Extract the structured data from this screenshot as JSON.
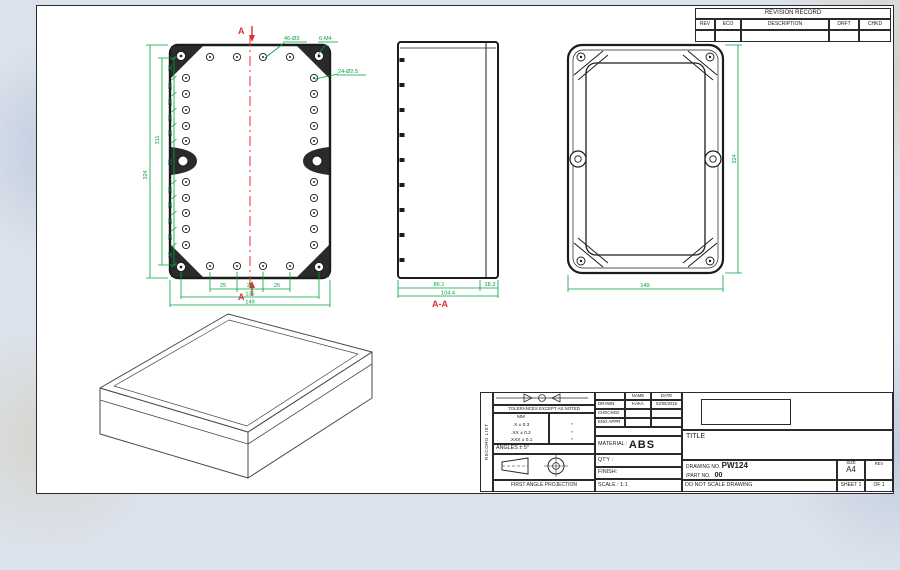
{
  "colors": {
    "dimension_green": "#00a33c",
    "section_red": "#e03231",
    "line_black": "#1c1c1c",
    "background": "#dce2eb",
    "sheet": "#ffffff"
  },
  "revision_table": {
    "title": "REVISION RECORD",
    "columns": [
      "REV",
      "ECO",
      "DESCRIPTION",
      "DRFT",
      "CHKD"
    ]
  },
  "front_view": {
    "section_marker_top": "A",
    "section_marker_bottom": "A",
    "annotations": {
      "small_holes": "46-Ø3",
      "corner_holes": "6-M4",
      "side_holes": "24-Ø2.5"
    },
    "left_chain": [
      "36",
      "28",
      "28",
      "28",
      "28",
      "72",
      "28",
      "28",
      "28",
      "28",
      "36"
    ],
    "left_inner_total": "311",
    "left_outer_total": "324",
    "bottom_chain": [
      "25",
      "25",
      "25"
    ],
    "bottom_inner_total": "135",
    "bottom_outer_total": "149"
  },
  "section_view": {
    "label": "A-A",
    "dims": [
      "86.1",
      "18.3"
    ],
    "total": "104.4"
  },
  "top_view": {
    "height_dim": "324",
    "width_dim": "149"
  },
  "title_block": {
    "strip": "RECORD LIST",
    "tolerance": {
      "heading": "TOLERANCES EXCEPT AS NOTED",
      "unit": "MM",
      "rows": [
        ".X ± 0.3",
        ".XX ± 0.2",
        ".XXX ± 0.1"
      ],
      "star": "*",
      "angles": "ANGLES ± 5°",
      "projection_caption": "FIRST ANGLE PROJECTION"
    },
    "signoff": {
      "name_header": "NAME",
      "date_header": "DATE",
      "drawn_label": "DRAWN",
      "drawn_name": "KAKA",
      "drawn_date": "02/05/2015",
      "checked_label": "CHECKED",
      "eng_appr_label": "ENG APPR"
    },
    "material_label": "MATERIAL :",
    "material_value": "ABS",
    "qty_label": "QT'Y :",
    "finish_label": "FINISH:",
    "scale_label": "SCALE : 1:1",
    "title_label": "TITLE",
    "drawing_no_label": "DRAWING NO.",
    "drawing_no": "PW124",
    "part_no_label": "/PART NO.",
    "part_no": "00",
    "size_label": "SIZE",
    "size_value": "A4",
    "rev_label": "REV",
    "do_not_scale": "DO NOT SCALE DRAWING",
    "sheet_label": "SHEET 1",
    "of_label": "OF 1"
  }
}
